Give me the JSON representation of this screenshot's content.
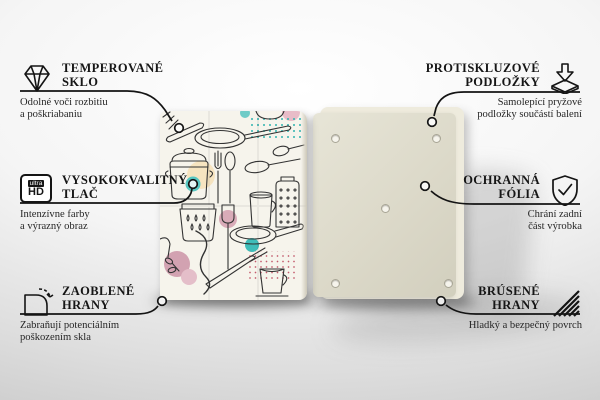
{
  "callouts": {
    "left": [
      {
        "icon": "diamond-icon",
        "title": [
          "TEMPEROVANÉ",
          "SKLO"
        ],
        "desc": [
          "Odolné voči rozbitiu",
          "a poškriabaniu"
        ]
      },
      {
        "icon": "ultra-hd-icon",
        "title": [
          "VYSOKOKVALITNÝ",
          "TLAČ"
        ],
        "desc": [
          "Intenzívne farby",
          "a výrazný obraz"
        ]
      },
      {
        "icon": "rounded-corner-icon",
        "title": [
          "ZAOBLENÉ",
          "HRANY"
        ],
        "desc": [
          "Zabraňují potenciálním",
          "poškozením skla"
        ]
      }
    ],
    "right": [
      {
        "icon": "anti-slip-pads-icon",
        "title": [
          "PROTISKLUZOVÉ",
          "PODLOŽKY"
        ],
        "desc": [
          "Samolepící pryžové",
          "podložky součástí balení"
        ]
      },
      {
        "icon": "shield-check-icon",
        "title": [
          "OCHRANNÁ",
          "FÓLIA"
        ],
        "desc": [
          "Chrání zadní",
          "část výrobka"
        ]
      },
      {
        "icon": "brushed-edges-icon",
        "title": [
          "BRÚSENÉ",
          "HRANY"
        ],
        "desc": [
          "Hladký a bezpečný povrch",
          ""
        ]
      }
    ]
  },
  "ultra_hd": {
    "top": "ultra",
    "bottom": "HD"
  },
  "product": {
    "front": "glass board front printed with kitchen utensil doodle pattern",
    "back": "board back with five self-adhesive anti-slip pads",
    "pad_count": 5
  },
  "colors": {
    "line": "#141414",
    "board_back": "#dcd9c9",
    "pattern_background": "#f6f4ec",
    "pattern_peach": "#f6e4c0",
    "pattern_teal": "#4cc2be",
    "pattern_pink": "#d4a5b3",
    "dots_teal": "#2fb3af",
    "dots_red": "#c35a6c"
  }
}
